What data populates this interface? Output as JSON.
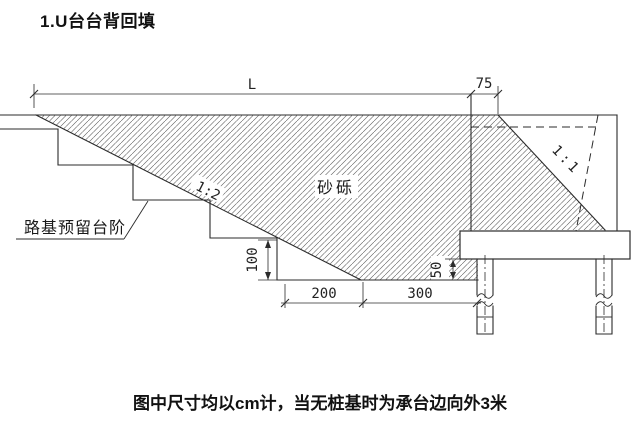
{
  "title": "1.U台台背回填",
  "caption": "图中尺寸均以cm计，当无桩基时为承台边向外3米",
  "diagram": {
    "labels": {
      "dim_L": "L",
      "dim_75": "75",
      "dim_100": "100",
      "dim_50": "50",
      "dim_200": "200",
      "dim_300": "300",
      "slope_main": "1:2",
      "slope_right": "1:1",
      "fill_material": "砂砾",
      "steps_note": "路基预留台阶"
    },
    "units_note_unit": "cm",
    "line_color": "#2b2b2b",
    "hatch_color": "#555555"
  }
}
